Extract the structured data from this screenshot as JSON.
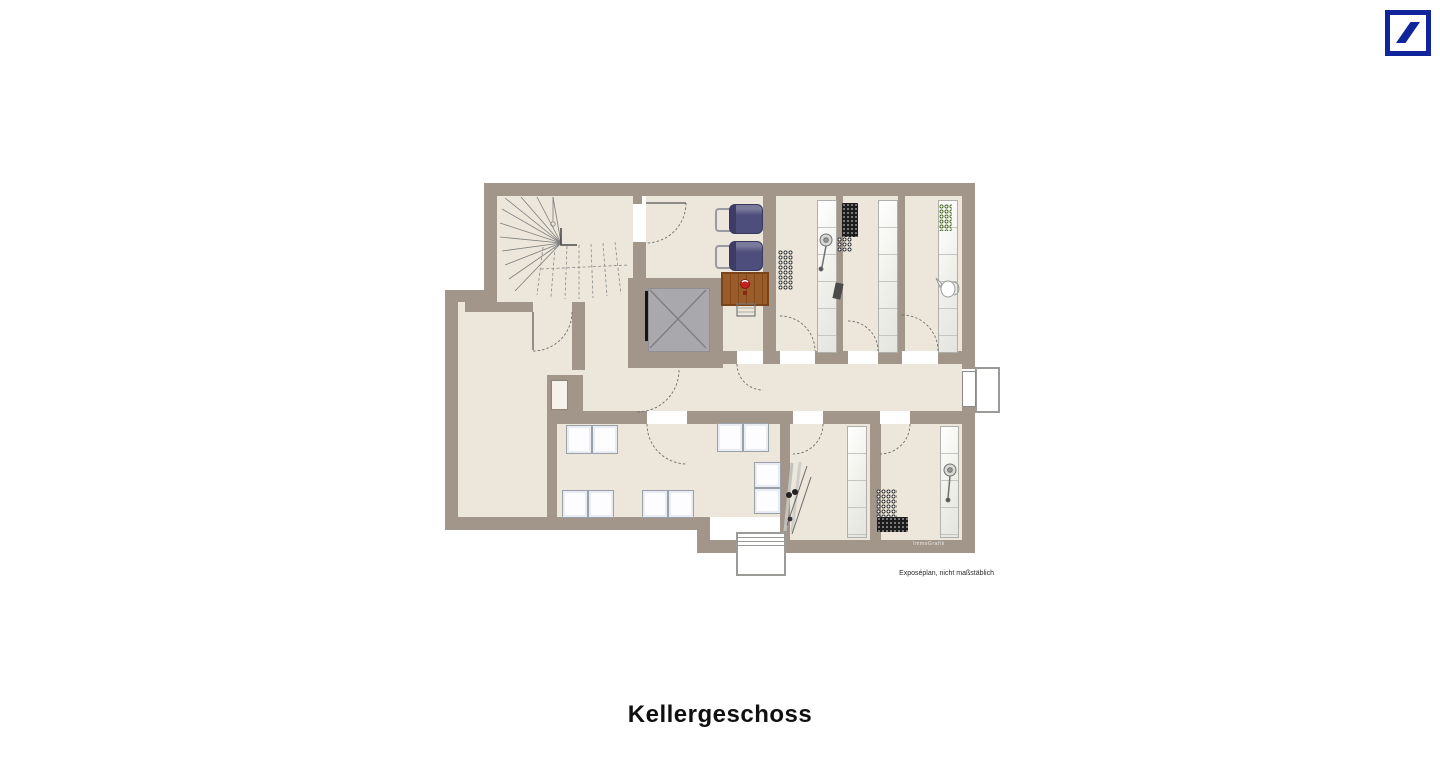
{
  "logo": {
    "name": "deutsche-bank-logo",
    "brand_blue": "#10249c"
  },
  "plan": {
    "title": "Kellergeschoss",
    "disclaimer": "Exposéplan, nicht maßstäblich",
    "watermark": "ImmoGrafik",
    "colors": {
      "wall": "#a29589",
      "floor": "#ece7da",
      "elevator_car": "#a9a9ad",
      "pram": "#4e4e7c",
      "workbench": "#9a5c28",
      "crate_green": "#55722f",
      "crate_dark": "#1c1c1c",
      "background": "#ffffff"
    },
    "icons": [
      "winder-staircase-icon",
      "elevator-icon",
      "pram-icon",
      "pram-icon",
      "workbench-icon",
      "stool-icon",
      "bottle-crate-icon",
      "storage-shelf-icon",
      "washing-machine-icon",
      "skis-icon",
      "vacuum-cleaner-icon",
      "watering-can-icon",
      "exterior-stairs-icon",
      "door-landing-icon"
    ]
  }
}
